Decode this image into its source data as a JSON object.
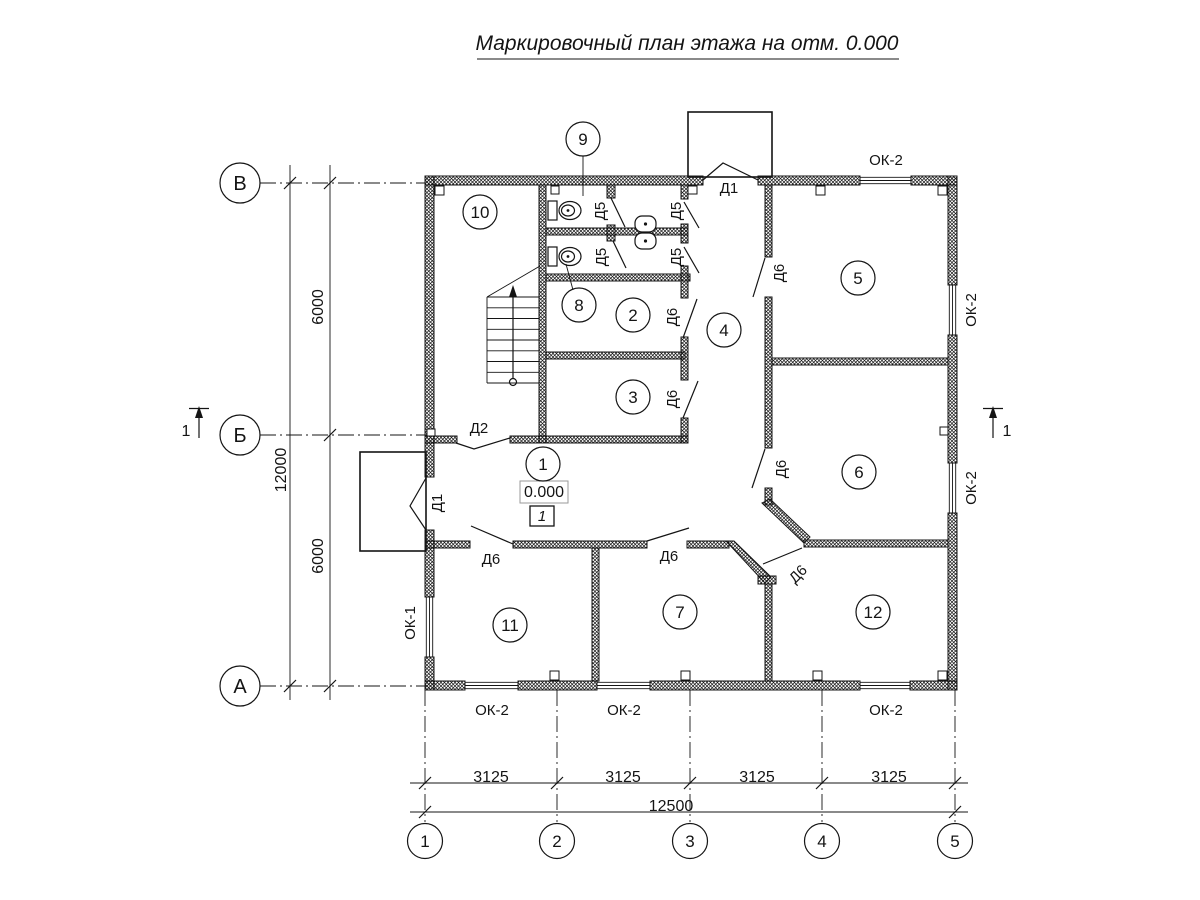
{
  "title": "Маркировочный план этажа на отм. 0.000",
  "colors": {
    "line": "#141414",
    "background": "#ffffff"
  },
  "axes": {
    "rows": [
      {
        "label": "В",
        "cx": 240,
        "cy": 183
      },
      {
        "label": "Б",
        "cx": 240,
        "cy": 435
      },
      {
        "label": "А",
        "cx": 240,
        "cy": 686
      }
    ],
    "cols": [
      {
        "label": "1",
        "cx": 425,
        "cy": 841
      },
      {
        "label": "2",
        "cx": 557,
        "cy": 841
      },
      {
        "label": "3",
        "cx": 690,
        "cy": 841
      },
      {
        "label": "4",
        "cx": 822,
        "cy": 841
      },
      {
        "label": "5",
        "cx": 955,
        "cy": 841
      }
    ]
  },
  "dimensions": {
    "left_total": "12000",
    "left_segments": [
      "6000",
      "6000"
    ],
    "bottom_segments": [
      "3125",
      "3125",
      "3125",
      "3125"
    ],
    "bottom_total": "12500",
    "items": [
      {
        "text": "12000",
        "x": 281,
        "y": 470,
        "rot": -90
      },
      {
        "text": "6000",
        "x": 318,
        "y": 307,
        "rot": -90
      },
      {
        "text": "6000",
        "x": 318,
        "y": 556,
        "rot": -90
      },
      {
        "text": "3125",
        "x": 491,
        "y": 777,
        "rot": 0
      },
      {
        "text": "3125",
        "x": 623,
        "y": 777,
        "rot": 0
      },
      {
        "text": "3125",
        "x": 757,
        "y": 777,
        "rot": 0
      },
      {
        "text": "3125",
        "x": 889,
        "y": 777,
        "rot": 0
      },
      {
        "text": "12500",
        "x": 671,
        "y": 806,
        "rot": 0
      }
    ]
  },
  "rooms": [
    {
      "number": "1",
      "cx": 543,
      "cy": 464
    },
    {
      "number": "2",
      "cx": 633,
      "cy": 315
    },
    {
      "number": "3",
      "cx": 633,
      "cy": 397
    },
    {
      "number": "4",
      "cx": 724,
      "cy": 330
    },
    {
      "number": "5",
      "cx": 858,
      "cy": 278
    },
    {
      "number": "6",
      "cx": 859,
      "cy": 472
    },
    {
      "number": "7",
      "cx": 680,
      "cy": 612
    },
    {
      "number": "8",
      "cx": 579,
      "cy": 305
    },
    {
      "number": "9",
      "cx": 583,
      "cy": 139
    },
    {
      "number": "10",
      "cx": 480,
      "cy": 212
    },
    {
      "number": "11",
      "cx": 510,
      "cy": 625
    },
    {
      "number": "12",
      "cx": 873,
      "cy": 612
    }
  ],
  "door_labels": [
    {
      "label": "Д1",
      "x": 729,
      "y": 188,
      "rot": 0
    },
    {
      "label": "Д1",
      "x": 437,
      "y": 503,
      "rot": -90
    },
    {
      "label": "Д2",
      "x": 479,
      "y": 428,
      "rot": 0
    },
    {
      "label": "Д5",
      "x": 600,
      "y": 211,
      "rot": -90
    },
    {
      "label": "Д5",
      "x": 601,
      "y": 257,
      "rot": -90
    },
    {
      "label": "Д5",
      "x": 676,
      "y": 211,
      "rot": -90
    },
    {
      "label": "Д5",
      "x": 676,
      "y": 257,
      "rot": -90
    },
    {
      "label": "Д6",
      "x": 779,
      "y": 273,
      "rot": -90
    },
    {
      "label": "Д6",
      "x": 672,
      "y": 317,
      "rot": -90
    },
    {
      "label": "Д6",
      "x": 672,
      "y": 399,
      "rot": -90
    },
    {
      "label": "Д6",
      "x": 781,
      "y": 469,
      "rot": -90
    },
    {
      "label": "Д6",
      "x": 491,
      "y": 559,
      "rot": 0
    },
    {
      "label": "Д6",
      "x": 669,
      "y": 556,
      "rot": 0
    },
    {
      "label": "Д6",
      "x": 798,
      "y": 574,
      "rot": -45
    }
  ],
  "window_labels": [
    {
      "label": "ОК-2",
      "x": 886,
      "y": 160,
      "rot": 0
    },
    {
      "label": "ОК-2",
      "x": 971,
      "y": 310,
      "rot": -90
    },
    {
      "label": "ОК-2",
      "x": 971,
      "y": 488,
      "rot": -90
    },
    {
      "label": "ОК-1",
      "x": 410,
      "y": 623,
      "rot": -90
    },
    {
      "label": "ОК-2",
      "x": 492,
      "y": 710,
      "rot": 0
    },
    {
      "label": "ОК-2",
      "x": 624,
      "y": 710,
      "rot": 0
    },
    {
      "label": "ОК-2",
      "x": 886,
      "y": 710,
      "rot": 0
    }
  ],
  "elevation": {
    "value": "0.000",
    "level": "1"
  },
  "section_marks": [
    {
      "label": "1",
      "x": 186,
      "y": 431
    },
    {
      "label": "1",
      "x": 1007,
      "y": 431
    }
  ]
}
